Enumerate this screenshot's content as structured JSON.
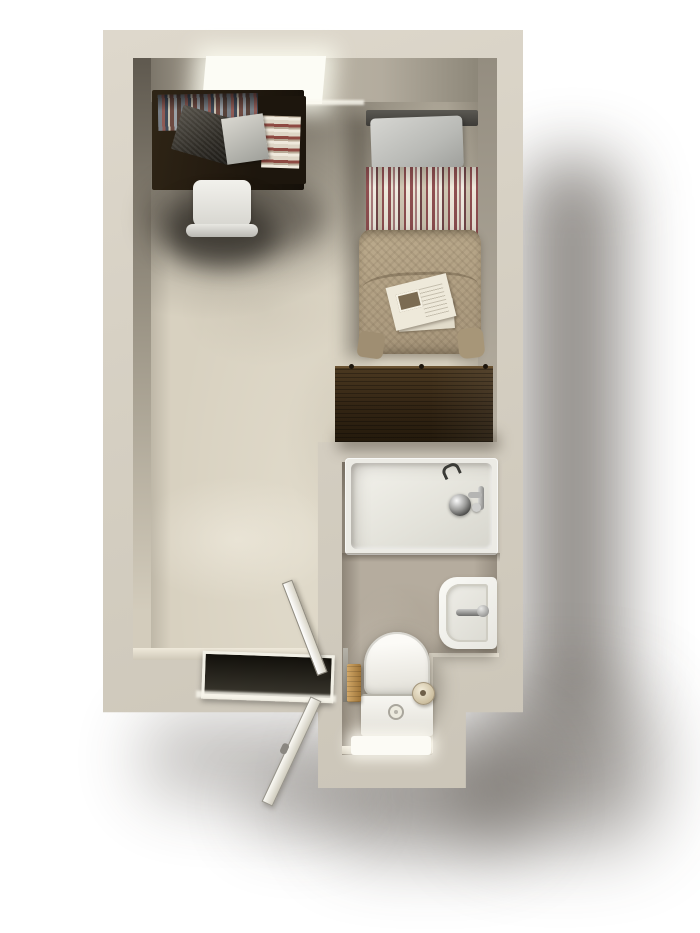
{
  "scene": {
    "label": "Top-down 3D render of a studio apartment floor plan with en-suite bathroom",
    "visible_text": ""
  },
  "colors": {
    "background": "#ffffff",
    "wall_face": "#d5cfc2",
    "inner_shade": "#958e80",
    "floor_main": "#d8d1c0",
    "floor_bath": "#b5ac9e",
    "wood_desk": "#241b10",
    "wood_dresser": "#322413",
    "blanket": "#a6957a",
    "stripe_red": "#8f4f51",
    "stripe_cream": "#e7e1d2",
    "pillow": "#b9bab6",
    "fixture_white": "#f2f1ec",
    "chrome": "#6e6e6c",
    "window_glow": "#fcfcf5",
    "shadow": "#3b342c"
  },
  "main_room": {
    "label": "Studio room",
    "items": [
      {
        "id": "window",
        "label": "Window in top wall"
      },
      {
        "id": "desk",
        "label": "Dark wood desk"
      },
      {
        "id": "desk-books",
        "label": "Row of books on desk shelf"
      },
      {
        "id": "desk-book-stack",
        "label": "Stacked books"
      },
      {
        "id": "laptop",
        "label": "Laptop"
      },
      {
        "id": "desk-papers",
        "label": "Loose papers"
      },
      {
        "id": "desk-chair",
        "label": "White chair"
      },
      {
        "id": "headboard",
        "label": "Bed headboard"
      },
      {
        "id": "pillow",
        "label": "Grey pillow"
      },
      {
        "id": "striped-sheet",
        "label": "Red striped sheet"
      },
      {
        "id": "blanket",
        "label": "Tan woven blanket"
      },
      {
        "id": "bed-papers",
        "label": "Newspaper on bed"
      },
      {
        "id": "dresser",
        "label": "Dark walnut dresser"
      }
    ]
  },
  "bathroom": {
    "label": "En-suite bathroom",
    "items": [
      {
        "id": "bathtub",
        "label": "Bathtub"
      },
      {
        "id": "tub-drain",
        "label": "Tub overflow drain"
      },
      {
        "id": "tub-faucet",
        "label": "Chrome tub faucet"
      },
      {
        "id": "tub-handle",
        "label": "Chrome wall handle"
      },
      {
        "id": "sink",
        "label": "Wall-mounted sink"
      },
      {
        "id": "sink-faucet",
        "label": "Sink faucet"
      },
      {
        "id": "toilet",
        "label": "Toilet with closed lid"
      },
      {
        "id": "toilet-tank",
        "label": "Toilet cistern"
      },
      {
        "id": "flush-button",
        "label": "Flush button"
      },
      {
        "id": "toilet-paper",
        "label": "Toilet paper roll"
      },
      {
        "id": "towel",
        "label": "Towel on rail"
      },
      {
        "id": "bath-mat",
        "label": "White bath mat"
      },
      {
        "id": "ledge",
        "label": "Half-wall ledge"
      }
    ]
  },
  "entry": {
    "label": "Entrance",
    "items": [
      {
        "id": "doorway",
        "label": "Entry doorway threshold"
      },
      {
        "id": "door-inner",
        "label": "Door leaf swung inward"
      },
      {
        "id": "door-outer",
        "label": "Door leaf swung outward"
      }
    ]
  }
}
